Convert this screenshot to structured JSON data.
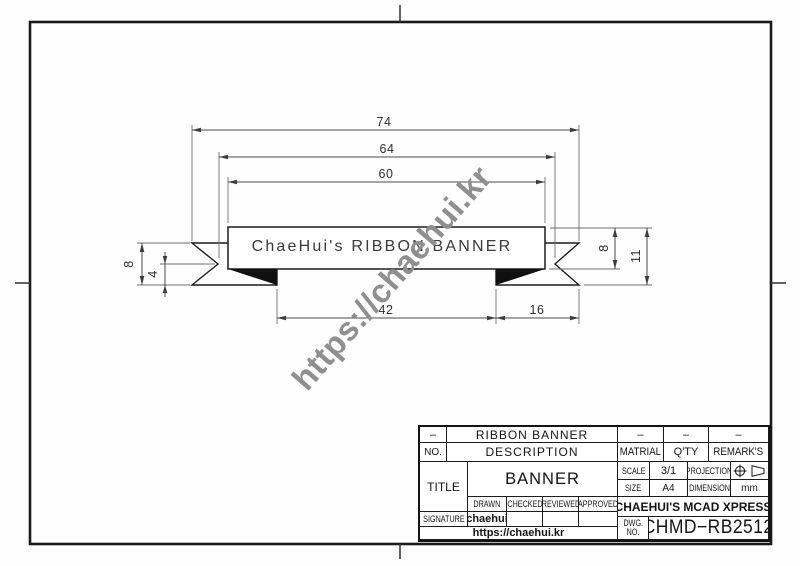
{
  "watermark": "https://chaehui.kr",
  "drawing": {
    "banner_text": "ChaeHui's RIBBON BANNER",
    "dims": {
      "total_width": "74",
      "notch_span": "64",
      "banner_width": "60",
      "tail_height": "8",
      "notch_depth": "4",
      "bottom_left": "42",
      "bottom_right": "16",
      "banner_height": "8",
      "total_height": "11"
    }
  },
  "title_block": {
    "rev_dash": "–",
    "item_name": "RIBBON BANNER",
    "matrial_dash": "–",
    "qty_dash": "–",
    "remarks_dash": "–",
    "no_label": "NO.",
    "description_label": "DESCRIPTION",
    "matrial_label": "MATRIAL",
    "qty_label": "Q'TY",
    "remarks_label": "REMARK'S",
    "title_label": "TITLE",
    "title_value": "BANNER",
    "scale_label": "SCALE",
    "scale_value": "3/1",
    "projection_label": "PROJECTION",
    "size_label": "SIZE",
    "size_value": "A4",
    "dimension_label": "DIMENSION",
    "dimension_value": "mm",
    "drawn_label": "DRAWN",
    "checked_label": "CHECKED",
    "reviewed_label": "REVIEWED",
    "approved_label": "APPROVED",
    "signature_label": "SIGNATURE",
    "drawn_value": "chaehui",
    "checked_value": "",
    "reviewed_value": "",
    "approved_value": "",
    "company": "CHAEHUI'S MCAD XPRESS",
    "dwg_label_line1": "DWG.",
    "dwg_label_line2": "NO.",
    "dwg_no": "CHMD−RB2512",
    "url": "https://chaehui.kr"
  }
}
